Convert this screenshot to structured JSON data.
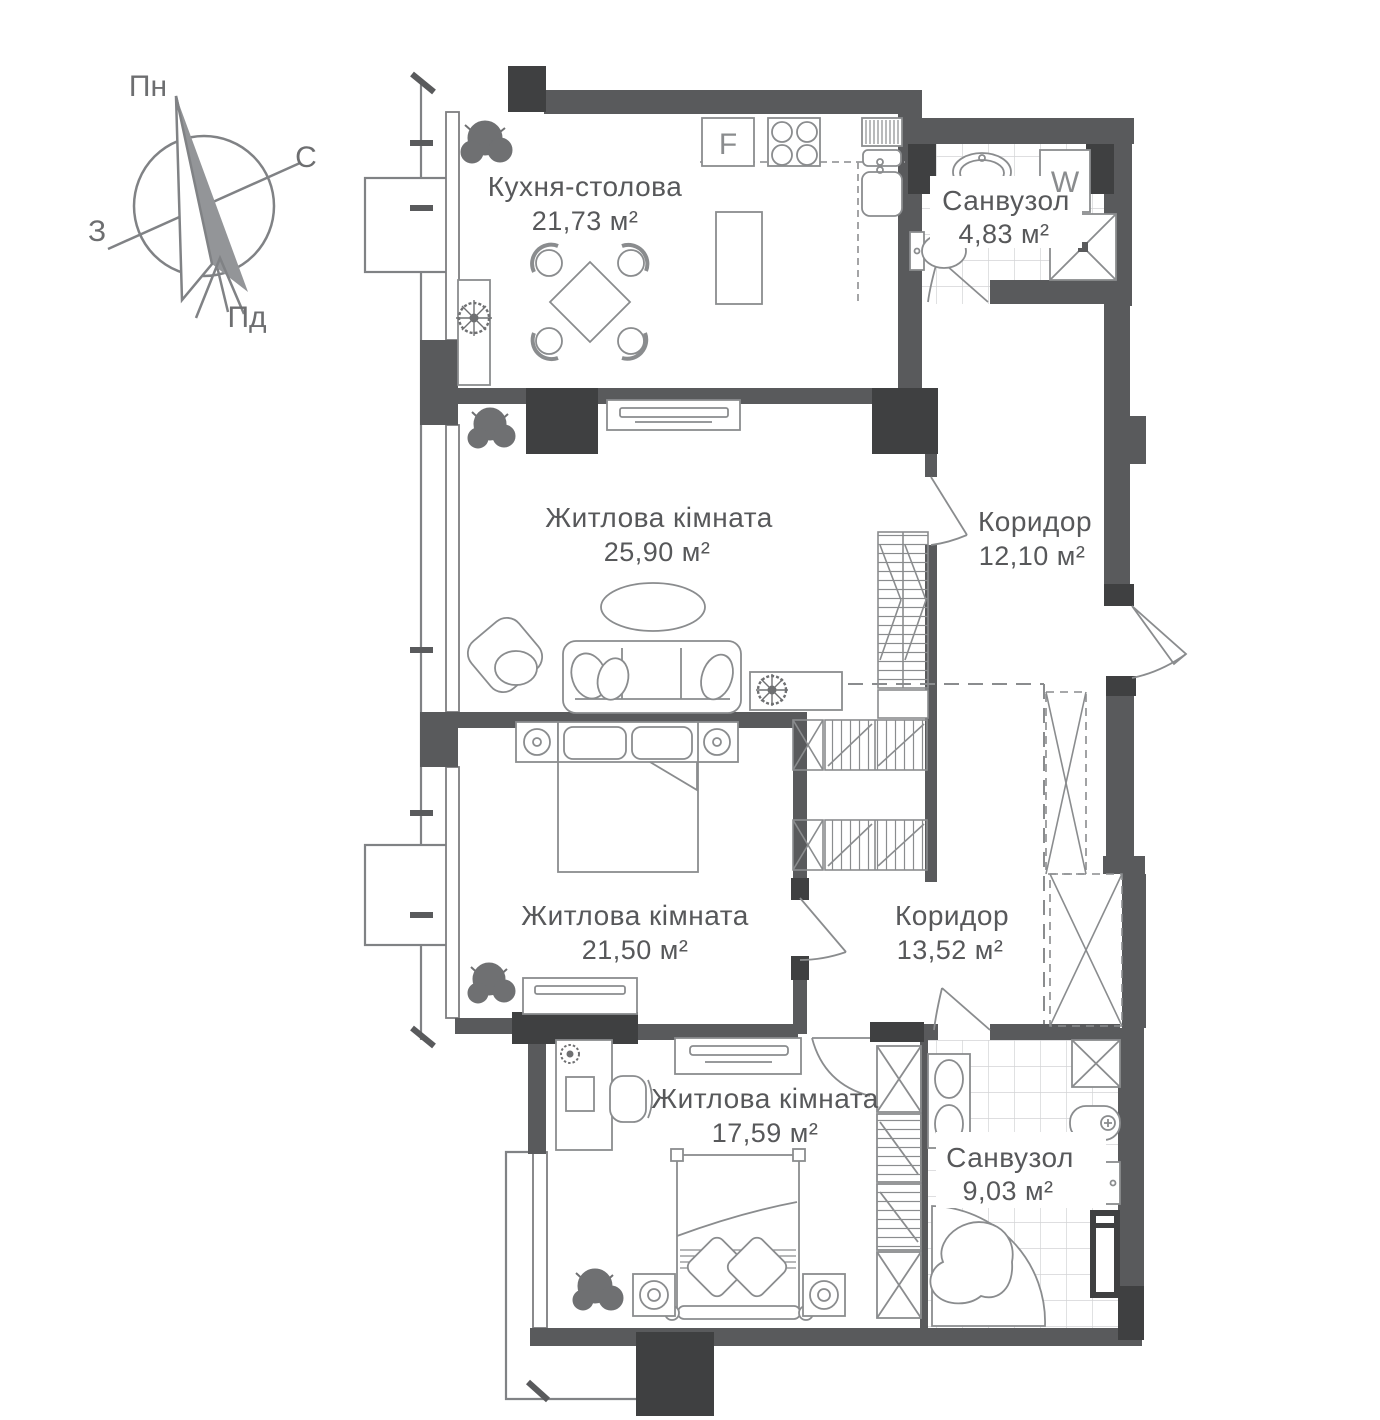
{
  "plan_title": "apartment-floor-plan",
  "compass": {
    "north_label": "Пн",
    "east_label": "С",
    "south_label": "Пд",
    "west_label": "З"
  },
  "rooms": [
    {
      "name": "Кухня-столова",
      "area": "21,73 м²"
    },
    {
      "name": "Санвузол",
      "area": "4,83 м²"
    },
    {
      "name": "Житлова кімната",
      "area": "25,90 м²"
    },
    {
      "name": "Коридор",
      "area": "12,10 м²"
    },
    {
      "name": "Житлова кімната",
      "area": "21,50 м²"
    },
    {
      "name": "Коридор",
      "area": "13,52 м²"
    },
    {
      "name": "Житлова кімната",
      "area": "17,59 м²"
    },
    {
      "name": "Санвузол",
      "area": "9,03 м²"
    }
  ],
  "appliances": {
    "fridge_label": "F",
    "washing_machine_label": "W"
  },
  "colors": {
    "wall": "#595a5c",
    "dark_block": "#3f4041",
    "furniture_line": "#8a8c8e",
    "tile_line": "#d3d4d5",
    "text": "#57585a",
    "background": "#ffffff"
  }
}
